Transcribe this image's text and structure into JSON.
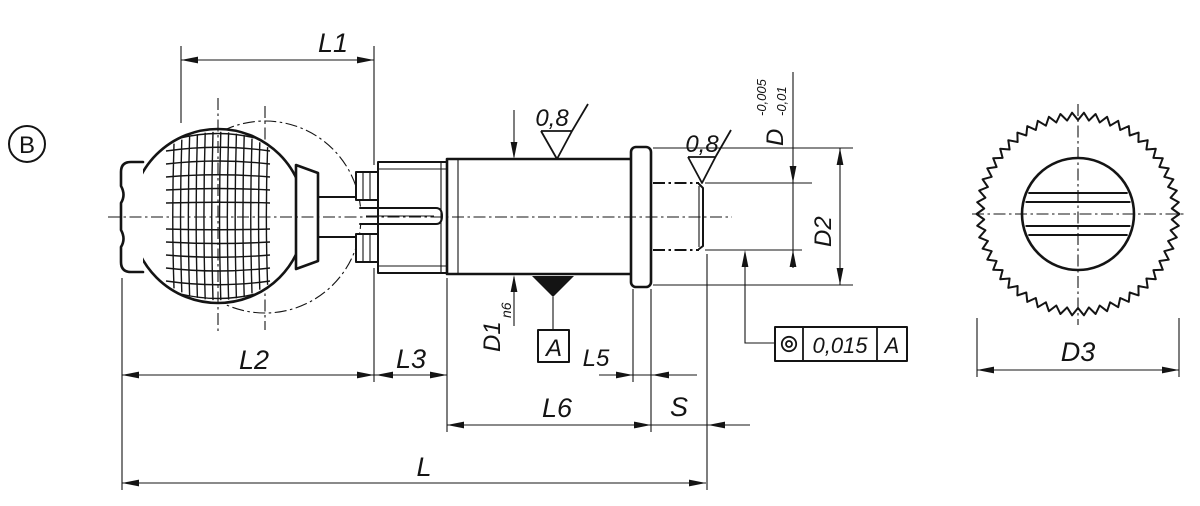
{
  "view": {
    "detail_label": "B"
  },
  "dimensions": {
    "L1": "L1",
    "L2": "L2",
    "L3": "L3",
    "L5": "L5",
    "L6": "L6",
    "S": "S",
    "L": "L",
    "D1": "D1",
    "D1_fit": "n6",
    "D": "D",
    "D_tol_upper": "-0,005",
    "D_tol_lower": "-0,01",
    "D2": "D2",
    "D3": "D3"
  },
  "surface_finish": {
    "body": "0,8",
    "pin": "0,8"
  },
  "datum": {
    "label": "A"
  },
  "feature_control_frame": {
    "symbol": "concentricity",
    "value": "0,015",
    "datum": "A"
  },
  "gear": {
    "teeth": 54
  },
  "colors": {
    "line": "#141414",
    "background": "#ffffff"
  }
}
